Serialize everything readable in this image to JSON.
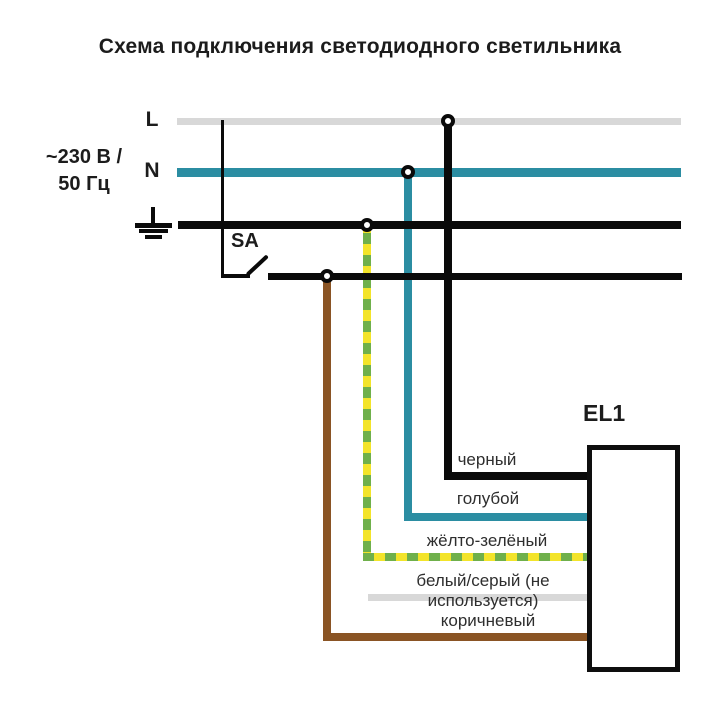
{
  "title": "Схема подключения светодиодного светильника",
  "supply": {
    "rating_line1": "~230 В /",
    "rating_line2": "50 Гц"
  },
  "buses": {
    "phase": {
      "label": "L",
      "color": "#d8d8d8"
    },
    "neutral": {
      "label": "N",
      "color": "#2b8da2"
    },
    "ground": {
      "color": "#0a0a0a"
    }
  },
  "switch": {
    "label": "SA"
  },
  "luminaire": {
    "label": "EL1"
  },
  "wires": [
    {
      "id": "black",
      "label": "черный",
      "color": "#0a0a0a"
    },
    {
      "id": "blue",
      "label": "голубой",
      "color": "#2b8da2"
    },
    {
      "id": "yellow-green",
      "label": "жёлто-зелёный",
      "colors": [
        "#f3e42a",
        "#6fb04b"
      ]
    },
    {
      "id": "white-gray",
      "label": "белый/серый (не используется)",
      "color": "#d8d8d8"
    },
    {
      "id": "brown",
      "label": "коричневый",
      "color": "#8a5424"
    }
  ]
}
